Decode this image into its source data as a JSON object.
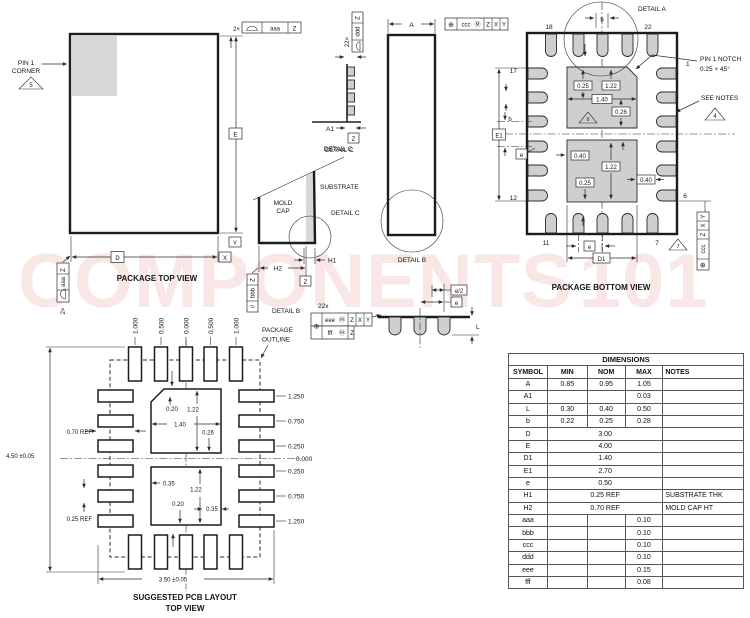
{
  "watermark": {
    "text": "COMPONENTS",
    "suffix": "101"
  },
  "top_view": {
    "title": "PACKAGE TOP VIEW",
    "pin1_label_1": "PIN 1",
    "pin1_label_2": "CORNER",
    "note_5": "5",
    "fcf_top_count": "2×",
    "fcf_top_tol": "aaa",
    "fcf_top_datum": "Z",
    "fcf_left_count": "2×",
    "fcf_left_tol": "aaa",
    "fcf_left_datum": "Z",
    "dim_e": "E",
    "dim_d": "D",
    "datum_x": "X",
    "datum_y": "Y"
  },
  "lead_profile": {
    "fcf_count": "22×",
    "fcf_tol": "ddd",
    "fcf_datum": "Z",
    "dim_a1": "A1",
    "datum_z": "Z",
    "label": "DETAIL C"
  },
  "mold_section": {
    "label_top": "DETAIL C",
    "mold_1": "MOLD",
    "mold_2": "CAP",
    "substrate": "SUBSTRATE",
    "detail_label": "DETAIL C",
    "dim_h1": "H1",
    "dim_h2": "H2",
    "datum_z": "Z",
    "fcf_sym": "//",
    "fcf_tol": "bbb",
    "fcf_datum": "Z",
    "detail_b_ref": "DETAIL B"
  },
  "side_view": {
    "dim_a": "A",
    "detail_b": "DETAIL B"
  },
  "fcf_ccc": {
    "sym": "⊕",
    "tol": "ccc",
    "mod": "Ⓜ",
    "d1": "Z",
    "d2": "X",
    "d3": "Y"
  },
  "bottom_view": {
    "title": "PACKAGE BOTTOM VIEW",
    "detail_a": "DETAIL A",
    "dim_b_top": "b",
    "pin_18": "18",
    "pin_22": "22",
    "pin_17": "17",
    "pin_12": "12",
    "pin_11": "11",
    "pin_7": "7",
    "pin_6": "6",
    "pin_1": "1",
    "pin1_notch_1": "PIN 1 NOTCH",
    "pin1_notch_2": "0.25 × 45°",
    "see_notes": "SEE NOTES",
    "note_4": "4",
    "note_6": "6",
    "note_7": "7",
    "dim_e1": "E1",
    "dim_b_left": "b",
    "dim_e_left": "e",
    "dim_e_bottom": "e",
    "dim_d1": "D1",
    "pad_top_dims": [
      "0.25",
      "1.22",
      "1.40",
      "0.26"
    ],
    "pad_bottom_dims": [
      "0.40",
      "1.22",
      "0.25",
      "0.40"
    ]
  },
  "detail_b_view": {
    "label": "DETAIL B",
    "count": "22x",
    "fcf_sym": "⊕",
    "row1_tol": "eee",
    "row1_mod": "Ⓜ",
    "row1_d1": "Z",
    "row1_d2": "X",
    "row1_d3": "Y",
    "row2_tol": "fff",
    "row2_mod": "Ⓜ",
    "row2_d1": "Z",
    "dim_e2": "e/2",
    "dim_e": "e",
    "dim_l": "L"
  },
  "pcb_layout": {
    "package_outline_1": "PACKAGE",
    "package_outline_2": "OUTLINE",
    "col_labels": [
      "1.000",
      "0.500",
      "0.000",
      "0.500",
      "1.000"
    ],
    "row_labels": [
      "1.250",
      "0.750",
      "0.250",
      "0.000",
      "0.250",
      "0.750",
      "1.250"
    ],
    "upper_pad_dims": [
      "0.20",
      "1.22",
      "1.40",
      "0.26"
    ],
    "lower_pad_dims": [
      "0.35",
      "1.22",
      "0.20",
      "0.35"
    ],
    "ref_070": "0.70 REF",
    "ref_025": "0.25 REF",
    "dim_height": "4.50 ±0.05",
    "dim_width": "3.50 ±0.05",
    "title_1": "SUGGESTED PCB LAYOUT",
    "title_2": "TOP VIEW"
  },
  "table": {
    "title": "DIMENSIONS",
    "headers": [
      "SYMBOL",
      "MIN",
      "NOM",
      "MAX",
      "NOTES"
    ],
    "rows": [
      {
        "symbol": "A",
        "min": "0.85",
        "nom": "0.95",
        "max": "1.05",
        "notes": ""
      },
      {
        "symbol": "A1",
        "min": "",
        "nom": "",
        "max": "0.03",
        "notes": ""
      },
      {
        "symbol": "L",
        "min": "0.30",
        "nom": "0.40",
        "max": "0.50",
        "notes": ""
      },
      {
        "symbol": "b",
        "min": "0.22",
        "nom": "0.25",
        "max": "0.28",
        "notes": ""
      },
      {
        "symbol": "D",
        "span": "3.00",
        "notes": ""
      },
      {
        "symbol": "E",
        "span": "4.00",
        "notes": ""
      },
      {
        "symbol": "D1",
        "span": "1.40",
        "notes": ""
      },
      {
        "symbol": "E1",
        "span": "2.70",
        "notes": ""
      },
      {
        "symbol": "e",
        "span": "0.50",
        "notes": ""
      },
      {
        "symbol": "H1",
        "span": "0.25 REF",
        "notes": "SUBSTRATE THK"
      },
      {
        "symbol": "H2",
        "span": "0.70 REF",
        "notes": "MOLD CAP HT"
      },
      {
        "symbol": "aaa",
        "min": "",
        "nom": "",
        "max": "0.10",
        "notes": ""
      },
      {
        "symbol": "bbb",
        "min": "",
        "nom": "",
        "max": "0.10",
        "notes": ""
      },
      {
        "symbol": "ccc",
        "min": "",
        "nom": "",
        "max": "0.10",
        "notes": ""
      },
      {
        "symbol": "ddd",
        "min": "",
        "nom": "",
        "max": "0.10",
        "notes": ""
      },
      {
        "symbol": "eee",
        "min": "",
        "nom": "",
        "max": "0.15",
        "notes": ""
      },
      {
        "symbol": "fff",
        "min": "",
        "nom": "",
        "max": "0.08",
        "notes": ""
      }
    ]
  }
}
